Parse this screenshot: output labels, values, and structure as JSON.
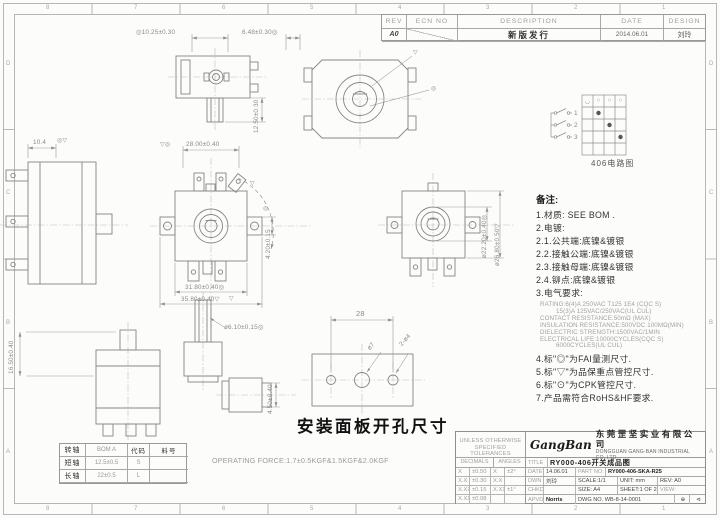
{
  "colors": {
    "line": "#8c8c8c",
    "text_dark": "#333333",
    "text_mid": "#777777",
    "text_light": "#a5a5a5"
  },
  "zones": {
    "cols": [
      "8",
      "7",
      "6",
      "5",
      "4",
      "3",
      "2",
      "1"
    ],
    "rows": [
      "D",
      "C",
      "B",
      "A"
    ]
  },
  "rev_table": {
    "headers": [
      "REV",
      "ECN NO",
      "DESCRIPTION",
      "DATE",
      "DESIGN"
    ],
    "row": {
      "rev": "A0",
      "ecn": "",
      "description": "新版发行",
      "date": "2014.06.01",
      "design": "刘玲"
    }
  },
  "circuit": {
    "header_icons": [
      "◡",
      "○",
      "○",
      "○"
    ],
    "poles": [
      "1",
      "2",
      "3"
    ],
    "caption": "406电路图"
  },
  "notes": {
    "title": "备注:",
    "lines": [
      "1.材质: SEE BOM .",
      "2.电镀:",
      "2.1.公共端:底镍&镀银",
      "2.2.接触公端:底镍&镀银",
      "2.3.接触母端:底镍&镀银",
      "2.4.铆点:底镍&镀银",
      "3.电气要求:"
    ],
    "electrical": [
      "RATING:6(4)A 250VAC T125 1E4 (CQC S)",
      "15(3)A 125VAC/250VAC(UL CUL)",
      "CONTACT RESISTANCE:50mΩ (MAX)",
      "INSULATION RESISTANCE:500VDC 100MΩ(MIN)",
      "DIELECTRIC STRENGTH:1500VAC/1MIN",
      "ELECTRICAL LIFE:10000CYCLES(CQC S)",
      "6000CYCLES(UL CUL)"
    ],
    "lines2": [
      "4.标\"◎\"为FAI量测尺寸.",
      "5.标\"▽\"为品保重点管控尺寸.",
      "6.标\"⊙\"为CPK管控尺寸.",
      "7.产品需符合RoHS&HF要求."
    ]
  },
  "dims": {
    "d1025": "◎10.25±0.30",
    "d648": "6.48±0.30◎",
    "d1250": "12.50±0.30",
    "d104": "10.4",
    "d2800": "28.00±0.40",
    "d3180": "31.80±0.40◎",
    "d3580": "35.80±0.40▽",
    "d420": "4.20±0.15",
    "d2220": "ø22.20±0.40◎",
    "d2680": "ø26.80±0.50▽",
    "d1650": "16.50±0.40",
    "d610": "ø6.10±0.15◎",
    "d450": "4.50±0.40",
    "p28": "28",
    "pd7": "ø7",
    "p2d4": "2-ø4",
    "mk_fai": "◎",
    "mk_qa": "▽",
    "mk_fai_qa": "◎▽",
    "mk_qa_fai": "▽◎"
  },
  "panel": {
    "caption": "安装面板开孔尺寸"
  },
  "operating_force": "OPERATING FORCE:1.7±0.5KGF&1.5KGF&2.0KGF",
  "shaft_table": {
    "rows": [
      [
        "转轴",
        "BOM A",
        "代码",
        "料号"
      ],
      [
        "短轴",
        "12.5±0.5",
        "S",
        ""
      ],
      [
        "长轴",
        "22±0.5",
        "L",
        ""
      ]
    ]
  },
  "title_block": {
    "unless1": "UNLESS OTHERWISE",
    "unless2": "SPECIFIED TOLERANCES",
    "decimals": "DECIMALS",
    "angles": "ANGLES",
    "tol": [
      [
        "X",
        "±0.50",
        "X",
        "±2°"
      ],
      [
        "X.X",
        "±0.30",
        "X.X",
        ""
      ],
      [
        "X.XX",
        "±0.15",
        "X.XX",
        "±1°"
      ],
      [
        "X.XXX",
        "±0.08",
        "",
        ""
      ]
    ],
    "company_script": "GangBan",
    "company_cn": "东莞罡坚实业有限公司",
    "company_en": "DONGGUAN GANG-BAN INDUSTRIAL CO.,LTD",
    "title_label": "TITLE",
    "title_value": "RY000-406开关成品图",
    "date_label": "DATE",
    "date_value": "14.06.01",
    "partno_label": "PART NO:",
    "partno_value": "RY000-406-SKA-R25",
    "dwn_label": "DWN",
    "dwn_value": "刘玲",
    "scale": "SCALE:1/1",
    "unit": "UNIT: mm",
    "rev": "REV: A0",
    "chkd_label": "CHKD",
    "chkd_value": "",
    "size": "SIZE: A4",
    "sheet": "SHEET:1 OF 2",
    "view_label": "VIEW:",
    "apvd_label": "APVD",
    "apvd_value": "Norris",
    "dwg_no": "DWG NO. WB-8-14-0001",
    "proj_icon1": "⊕",
    "proj_icon2": "⊲"
  }
}
